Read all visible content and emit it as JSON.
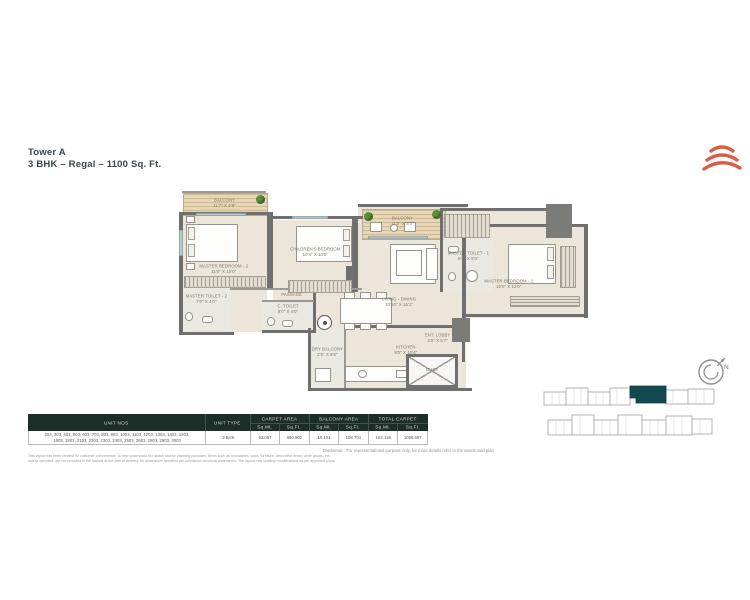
{
  "title": {
    "line1": "Tower A",
    "line2": "3 BHK – Regal – 1100 Sq. Ft."
  },
  "brand": {
    "logo_color": "#dd5a43"
  },
  "floor_plan": {
    "rooms": {
      "balcony_2": {
        "label": "BALCONY",
        "dims": "11'7\" X 2'9\""
      },
      "master_bedroom_2": {
        "label": "MASTER BEDROOM - 2",
        "dims": "11'0\" X 10'0\""
      },
      "master_toilet_2": {
        "label": "MASTER TOILET - 2",
        "dims": "7'0\" X 4'0\""
      },
      "children_bedroom": {
        "label": "CHILDREN'S BEDROOM",
        "dims": "10'4\" X 10'0\""
      },
      "passage": {
        "label": "PASSAGE",
        "dims": ""
      },
      "c_toilet": {
        "label": "C. TOILET",
        "dims": "8'0\" X 4'0\""
      },
      "balcony_1": {
        "label": "BALCONY",
        "dims": "11'0\" X 4'0\""
      },
      "living_dining": {
        "label": "LIVING - DINING",
        "dims": "10'10\" X 16'1\""
      },
      "master_toilet_1": {
        "label": "MASTER TOILET - 1",
        "dims": "5'0\" X 8'0\""
      },
      "master_bedroom_1": {
        "label": "MASTER BEDROOM - 1",
        "dims": "10'0\" X 12'0\""
      },
      "dry_balcony": {
        "label": "DRY BALCONY",
        "dims": "2'6\" X 8'8\""
      },
      "kitchen": {
        "label": "KITCHEN",
        "dims": "8'0\" X 10'4\""
      },
      "ent_lobby": {
        "label": "ENT. LOBBY",
        "dims": "4'0\" X 5'7\""
      },
      "duct": {
        "label": "DUCT",
        "dims": ""
      }
    }
  },
  "compass": {
    "north": "N"
  },
  "key_plan": {
    "highlight_color": "#134a51"
  },
  "table": {
    "headers": {
      "unit_nos": "UNIT NOS",
      "unit_type": "UNIT TYPE",
      "carpet_area": "CARPET AREA",
      "balcony_area": "BALCONY AREA",
      "total_carpet": "TOTAL CARPET",
      "sqmt": "Sq.Mt.",
      "sqft": "Sq.Ft."
    },
    "row": {
      "unit_nos_line1": "203, 303, 403, 503, 603, 703, 803, 903, 1003, 1103, 1203, 1303, 1403, 1503,",
      "unit_nos_line2": "1603, 1803, 2103, 2203, 2303, 2403, 2503, 2603, 2803, 2903, 3003",
      "unit_type": "3 BHK",
      "carpet_sqmt": "92.057",
      "carpet_sqft": "990.902",
      "balcony_sqmt": "10.101",
      "balcony_sqft": "108.704",
      "total_sqmt": "102.158",
      "total_sqft": "1099.607"
    }
  },
  "disclaimer": "Disclaimer : For representational purpose only, for more details refer to the sanctioned plan",
  "fine_print": {
    "line1": "This layout has been created for customer convenience, to help understand the space and for planning purposes. Items such as boundaries, walls, furniture, decorative items, white goods, etc.,",
    "line2": "unless specified, are not provided in the flat/unit at the time of delivery. All dimensions specified are unfinished structural dimensions. The layout may undergo modifications as per approved plans."
  }
}
